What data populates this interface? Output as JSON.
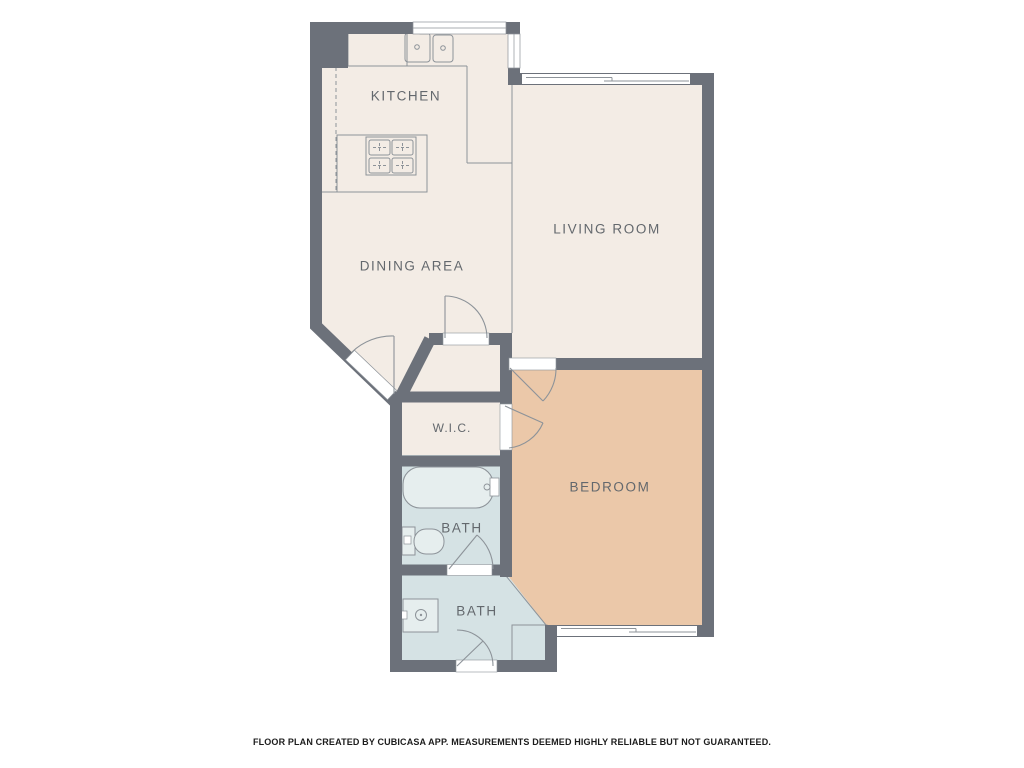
{
  "rooms": {
    "kitchen": {
      "label": "KITCHEN"
    },
    "dining_area": {
      "label": "DINING AREA"
    },
    "living_room": {
      "label": "LIVING ROOM"
    },
    "wic": {
      "label": "W.I.C."
    },
    "bath_upper": {
      "label": "BATH"
    },
    "bath_lower": {
      "label": "BATH"
    },
    "bedroom": {
      "label": "BEDROOM"
    }
  },
  "footer": {
    "disclaimer": "FLOOR PLAN CREATED BY CUBICASA APP. MEASUREMENTS DEEMED HIGHLY RELIABLE BUT NOT GUARANTEED."
  },
  "fixtures": {
    "stove": "stove-icon",
    "kitchen_sink": "kitchen-sink-icon",
    "bathtub": "bathtub-icon",
    "toilet": "toilet-icon",
    "vanity_sink": "vanity-sink-icon",
    "shower": "shower-icon"
  },
  "colors": {
    "wall": "#6c717a",
    "floor_main": "#f3ece5",
    "floor_bedroom": "#ebc8a9",
    "floor_bath": "#d5e2e4",
    "line": "#8d9399",
    "label_text": "#63686d",
    "footer_text": "#1c1c1c"
  }
}
